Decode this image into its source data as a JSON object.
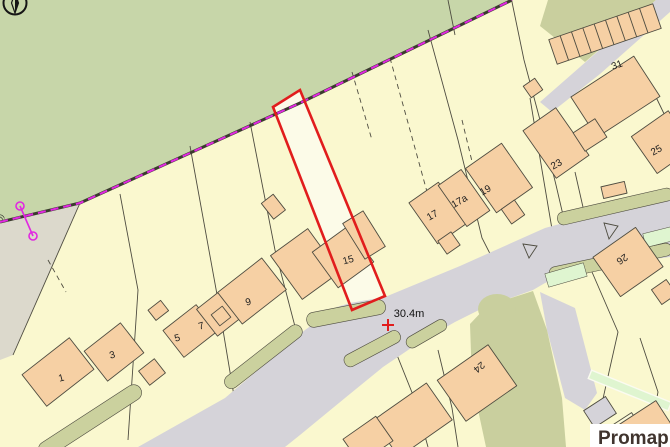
{
  "map": {
    "labels": {
      "h1": "1",
      "h3": "3",
      "h5": "5",
      "h7": "7",
      "h9": "9",
      "h15": "15",
      "h17": "17",
      "h17a": "17a",
      "h19": "19",
      "h23": "23",
      "h25": "25",
      "h26": "26",
      "h31": "31",
      "h24": "24"
    },
    "measurement": "30.4m",
    "edge_text": "))",
    "brand": "Promap"
  },
  "colors": {
    "plot": "#faf8cf",
    "paper": "#fcfbe8",
    "field": "#c7d6a9",
    "olive": "#c9cf9e",
    "wedge": "#dcd9cc",
    "road": "#d5d3d9",
    "verge": "#cbd19e",
    "light_green": "#dff5d0",
    "building": "#f6d0a4",
    "building_pale": "#fbf9d9",
    "line": "#4e4c40",
    "red_plot": "#e11d1d",
    "magenta": "#e128e1",
    "label": "#1f1f1f",
    "brand": "#40342e"
  }
}
